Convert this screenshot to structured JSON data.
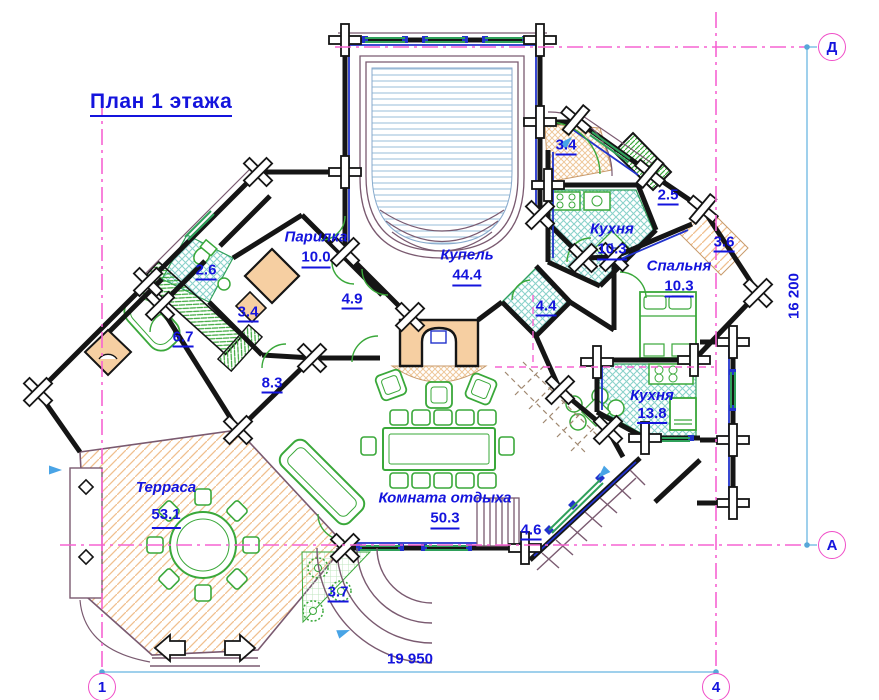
{
  "title": "План 1 этажа",
  "rooms": {
    "parilka": {
      "name": "Парилка",
      "area": "10.0"
    },
    "kupel": {
      "name": "Купель",
      "area": "44.4"
    },
    "kitchen_top": {
      "name": "Кухня",
      "area": "10.3"
    },
    "bedroom": {
      "name": "Спальня",
      "area": "10.3"
    },
    "kitchen_right": {
      "name": "Кухня",
      "area": "13.8"
    },
    "rest_room": {
      "name": "Комната отдыха",
      "area": "50.3"
    },
    "terrace": {
      "name": "Терраса",
      "area": "53.1"
    }
  },
  "small_areas": {
    "entry_top": "3.4",
    "pantry": "2.5",
    "hall_ne": "3.6",
    "wc_left": "2.6",
    "hall_left": "3.4",
    "bath_left": "6.7",
    "hall_center": "4.9",
    "corridor": "8.3",
    "bath_center": "4.4",
    "stairs": "4.6",
    "steps": "3.7"
  },
  "dimensions": {
    "bottom": "19 950",
    "right": "16 200"
  },
  "axis_markers": {
    "top_right": "Д",
    "right_bottom": "А",
    "bottom_left": "1",
    "bottom_right": "4"
  },
  "colors": {
    "label_blue": "#1414dd",
    "wall_black": "#151515",
    "wall_blue": "#2233cc",
    "furniture_green": "#3aa83a",
    "floor_tan_hatch": "#f0bf8e",
    "floor_teal_hatch": "#8ad2ca",
    "axis_magenta": "#f663d2",
    "dimension_blue": "#9fd0ec",
    "pool_outline": "#7a5a70"
  }
}
